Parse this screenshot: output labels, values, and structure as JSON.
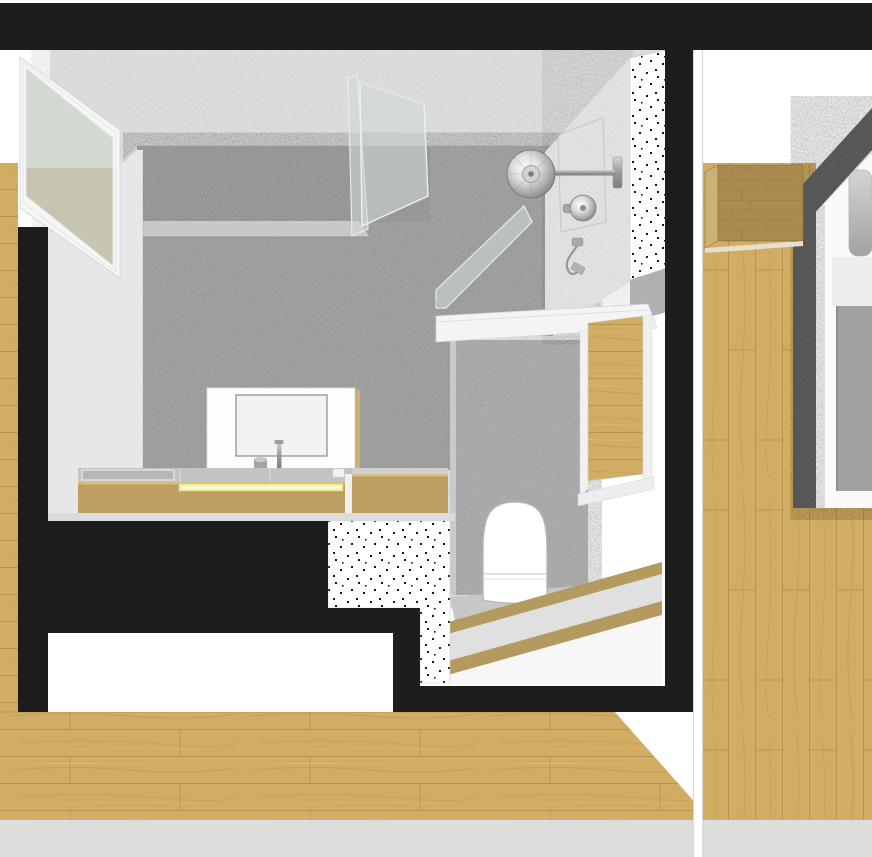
{
  "meta": {
    "type": "architectural-cutaway-render",
    "view": "axonometric-section",
    "rooms": [
      "bathroom",
      "bedroom"
    ]
  },
  "palette": {
    "background": "#ffffff",
    "cut_wall_black": "#1d1d1d",
    "plaster_light": "#e1e1e1",
    "fixture_wall": "#e6e6e6",
    "microcement_gray": "#a9a9a9",
    "microcement_upper": "#a2a2a2",
    "microcement_light": "#b5b5b5",
    "flat_wall": "#e7e7e7",
    "ledge_gray": "#c8c8c8",
    "wood_floor": "#d1ac63",
    "counter_wood": "#bfa163",
    "cabinet_wood": "#aa8c50",
    "step_wood": "#b49a5f",
    "step_tread": "#e0e0e0",
    "concrete_floor": "#c7c7c7",
    "counter_top": "#c3c3c3",
    "led_strip": "#f4f2a2",
    "glass_tint": "rgba(206,217,209,0.58)",
    "window_glass_upper": "#d2d9d1",
    "window_glass_lower": "#c7c4b1",
    "carpet_dark": "#5e5e5e",
    "blanket_gray": "#a1a1a1",
    "mirror_face": "#f2f2f2",
    "floor_base_strip": "#dcdcdc",
    "dot_black": "#161616"
  },
  "scene": {
    "bathroom_features": [
      "window-glass-panel",
      "microcement-walls",
      "glass-shower-partition",
      "rain-shower-head",
      "shower-thermostat",
      "hand-shower",
      "mosaic-dotted-section",
      "vanity-counter",
      "led-light-strip",
      "mirror-panel",
      "basin-faucet",
      "tumbler-cup",
      "wall-hung-toilet",
      "floor-flush-plate",
      "wooden-steps",
      "doorway-opening",
      "parquet-floor",
      "black-section-cut-walls"
    ],
    "bedroom_features": [
      "parquet-floor",
      "dark-carpet-runner",
      "wall-mounted-cabinet",
      "bed-mattress",
      "pillow",
      "gray-blanket"
    ]
  }
}
